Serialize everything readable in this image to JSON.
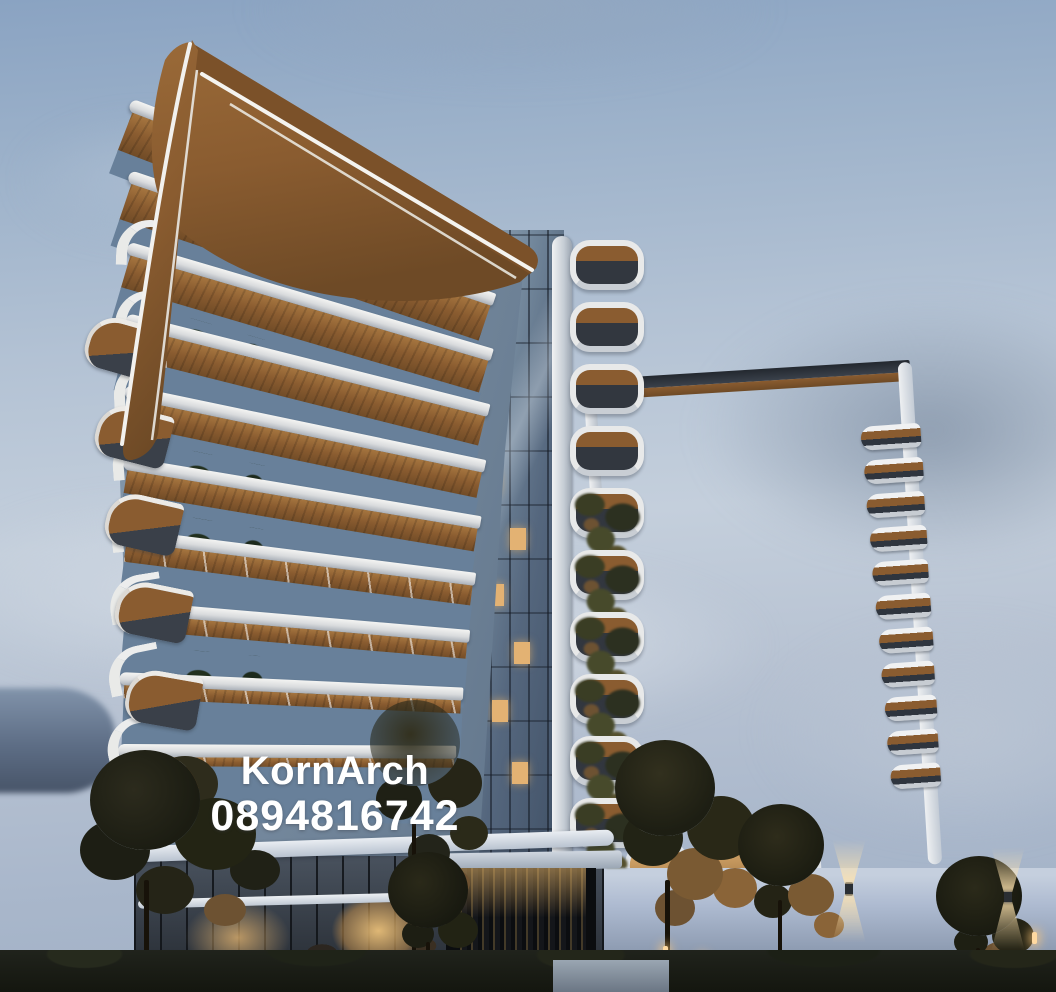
{
  "scene": {
    "title": "Modern twin residential towers with curved balconies at dusk",
    "watermark": {
      "line1": "KornArch",
      "line2": "0894816742"
    },
    "environment": {
      "time_of_day": "dusk",
      "sky": "soft blue with gray clouds",
      "lighting": "warm interior and landscape lights"
    },
    "structure": {
      "left_tower_floors": 10,
      "right_tower_floors": 13,
      "pod_balconies": 10,
      "left_fin_balconies": 6,
      "right_fin_balconies": 11,
      "entry_arches": 3
    },
    "colors": {
      "sky_top": "#8aa3c2",
      "sky_mid": "#c4cfdc",
      "cloud": "#ccd5e0",
      "cloud_gray": "#8e9db0",
      "sea": "#5d6d85",
      "copper": "#8a5c30",
      "copper_light": "#a5753f",
      "copper_dark": "#6e4a26",
      "band_white": "#d9dbdd",
      "band_shade": "#c6cdd6",
      "glass_light": "#9db0c2",
      "glass_dark": "#3f4f64",
      "window_dark": "#2d333d",
      "warm_light": "#e3b273",
      "foliage": "#23241b",
      "foliage_warm": "#6d5232",
      "wall": "#aebbd1",
      "gate": "#15171a",
      "ground": "#14160f"
    }
  }
}
